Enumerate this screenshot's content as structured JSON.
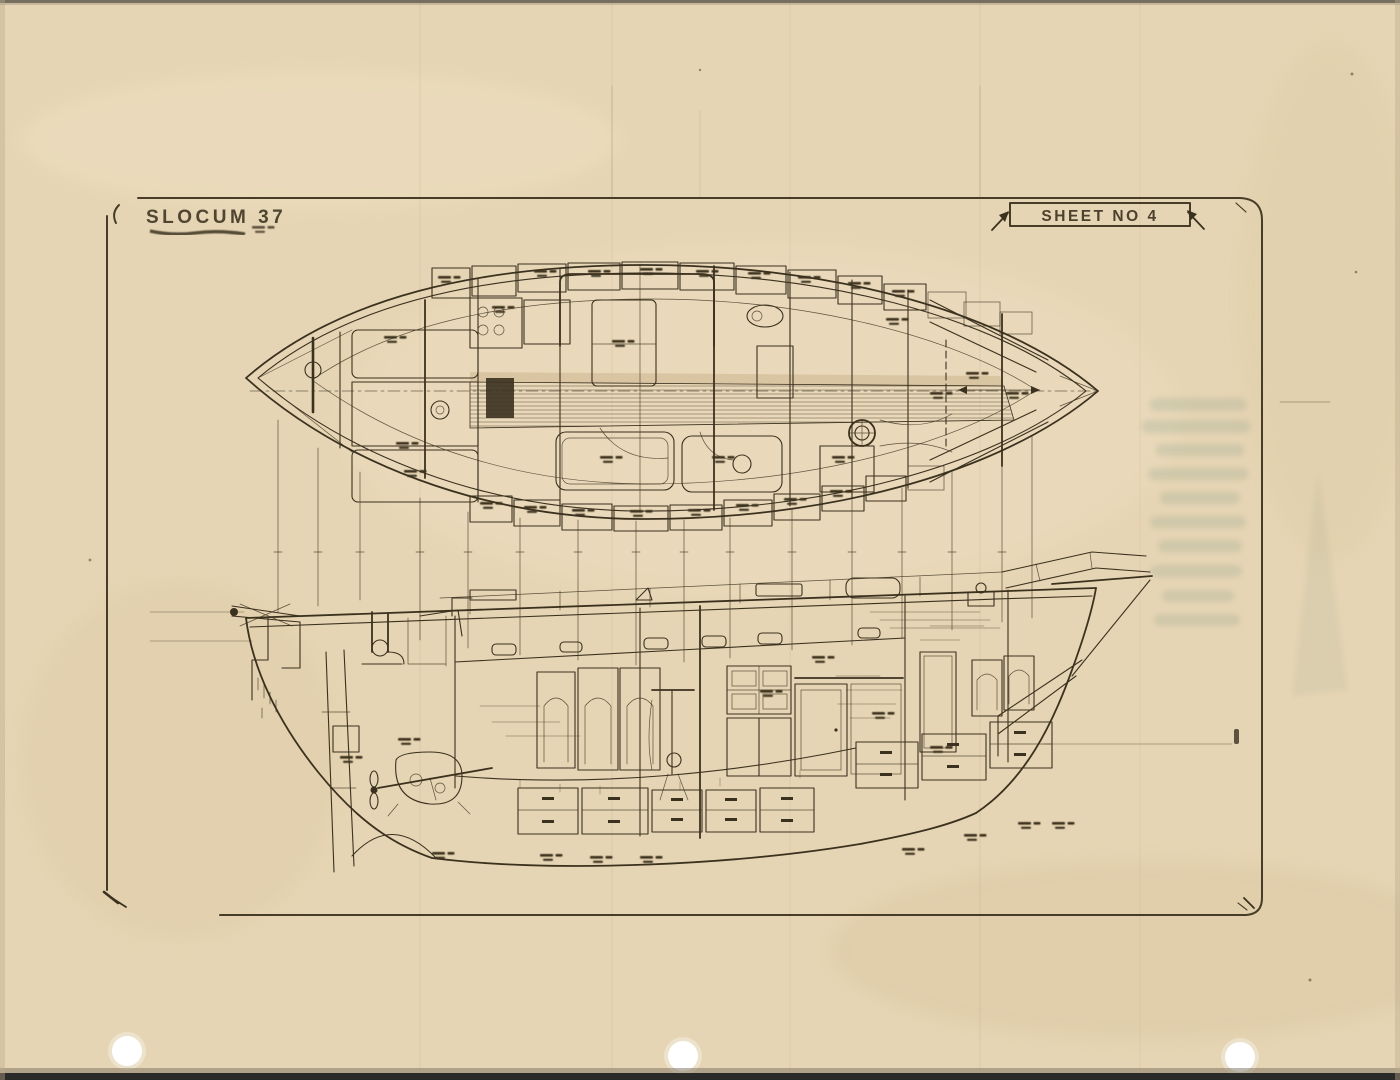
{
  "document": {
    "title": "SLOCUM 37",
    "sheet_label": "SHEET NO 4"
  },
  "colors": {
    "paper": "#e6d5b4",
    "paper_light": "#eee0c2",
    "paper_dark": "#d6c29c",
    "ink": "#3b311f",
    "frame": "#473c28",
    "ghost": "#4f7d6e"
  }
}
